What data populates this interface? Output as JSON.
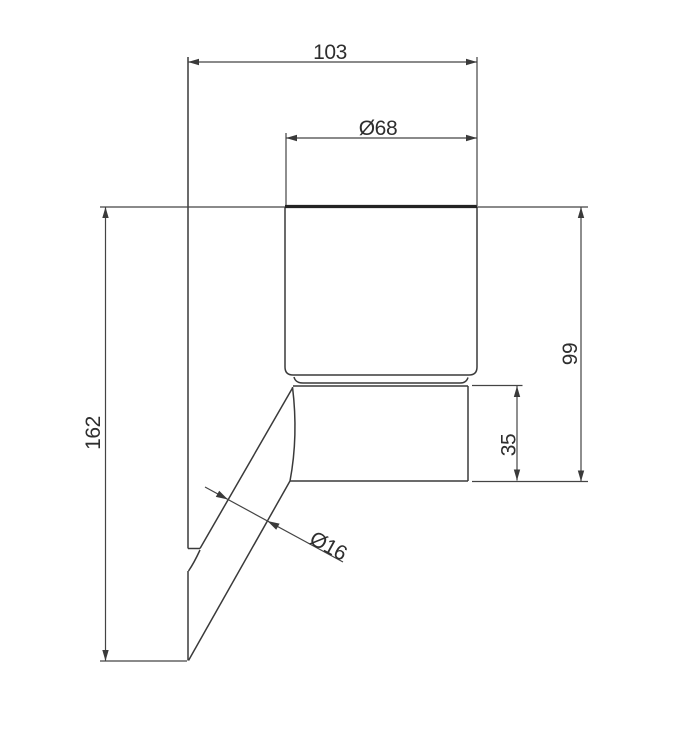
{
  "drawing": {
    "type": "technical-dimension-drawing",
    "subject": "wall-mounted tumbler holder, side elevation",
    "units": "mm",
    "labels": {
      "overall_width": "103",
      "cup_diameter": "Ø68",
      "overall_height": "162",
      "cup_top_to_holder_bottom": "99",
      "holder_height": "35",
      "arm_diameter": "Ø16"
    },
    "colors": {
      "background": "#ffffff",
      "line": "#3a3a3a",
      "text": "#2e2e2e"
    }
  }
}
